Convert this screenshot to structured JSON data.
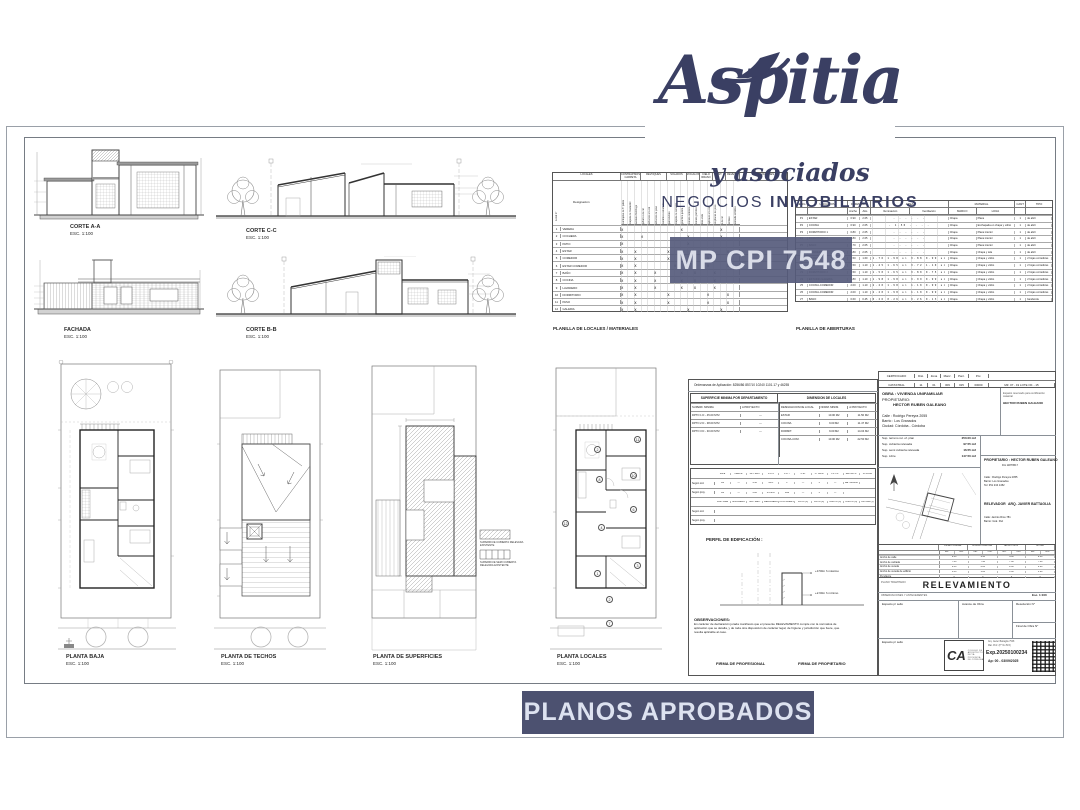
{
  "brand": {
    "name": "Aspitia",
    "tagline": "y asociados",
    "subtitle_prefix": "NEGOCIOS",
    "subtitle_bold": "INMOBILIARIOS",
    "badge": "MP CPI 7548",
    "accent": "#3a3f63"
  },
  "banner": {
    "label": "PLANOS APROBADOS"
  },
  "drawings": {
    "corte_aa": {
      "title": "CORTE A-A",
      "scale": "ESC. 1:100"
    },
    "fachada": {
      "title": "FACHADA",
      "scale": "ESC. 1:100"
    },
    "corte_cc": {
      "title": "CORTE C-C",
      "scale": "ESC. 1:100"
    },
    "corte_bb": {
      "title": "CORTE B-B",
      "scale": "ESC. 1:100"
    },
    "planta_baja": {
      "title": "PLANTA BAJA",
      "scale": "ESC. 1:100"
    },
    "planta_techos": {
      "title": "PLANTA DE TECHOS",
      "scale": "ESC. 1:100"
    },
    "planta_superficies": {
      "title": "PLANTA DE SUPERFICIES",
      "scale": "ESC. 1:100"
    },
    "planta_locales": {
      "title": "PLANTA LOCALES",
      "scale": "ESC. 1:100"
    }
  },
  "locales_table": {
    "title": "PLANILLA DE LOCALES / MATERIALES",
    "corner": "Local n°",
    "designacion": "Designación",
    "groups": [
      {
        "label": "LOCALES",
        "w": 68
      },
      {
        "label": "CONTRAPISOS CARPETA",
        "w": 20
      },
      {
        "label": "REVOQUES",
        "w": 26
      },
      {
        "label": "SOLADOS",
        "w": 20
      },
      {
        "label": "ZOCALOS",
        "w": 13
      },
      {
        "label": "CIELO RRASO",
        "w": 13
      },
      {
        "label": "PINT.",
        "w": 13
      },
      {
        "label": "REVEST.",
        "w": 14
      },
      {
        "label": "OBSERVACIONES",
        "w": 47
      }
    ],
    "materials": [
      "contrapiso de h° pobre",
      "carpeta de nivelación",
      "azotado hidrófugo",
      "jaharro a la cal",
      "enlucido a la cal",
      "enlucido de yeso",
      "cerámico esmaltado",
      "porcelanato",
      "carpeta de cemento",
      "granítico pulido",
      "zócalo cerámico",
      "zócalo granítico",
      "losa vista",
      "aplicado a la cal",
      "de placas de yeso",
      "a la cal",
      "al látex",
      "esmalte sintético"
    ],
    "rows": [
      {
        "n": "1",
        "name": "VEREDA",
        "marks": "x        x     x  "
      },
      {
        "n": "2",
        "name": "COCHERA",
        "marks": "x  x      x    x  "
      },
      {
        "n": "3",
        "name": "PATIO",
        "marks": "x         x       "
      },
      {
        "n": "4",
        "name": "ESTAR",
        "marks": "x x    x     x  x "
      },
      {
        "n": "5",
        "name": "COMEDOR",
        "marks": "x x    x     x  x "
      },
      {
        "n": "6",
        "name": "ESTAR COMEDOR",
        "marks": "x x     x    x  x "
      },
      {
        "n": "7",
        "name": "BAÑO",
        "marks": "x x  x   x x  x   "
      },
      {
        "n": "8",
        "name": "COCINA",
        "marks": "x x  x   x x  x   "
      },
      {
        "n": "9",
        "name": "LAVADERO",
        "marks": "x x  x   x x  x   "
      },
      {
        "n": "10",
        "name": "DORMITORIO",
        "marks": "x x    x     x  x "
      },
      {
        "n": "11",
        "name": "PASO",
        "marks": "x x    x     x  x "
      },
      {
        "n": "12",
        "name": "GALERIA",
        "marks": "x x       x    x  "
      }
    ]
  },
  "aberturas_table": {
    "title": "PLANILLA DE ABERTURAS",
    "h": {
      "desig": "DESIG.",
      "ubicacion": "UBICACION",
      "dim": "DIMENSION",
      "ancho": "Ancho",
      "alto": "Alto",
      "area": "AREA",
      "ilum": "Iluminación",
      "vent": "Ventilación",
      "material": "MATERIAL",
      "marco": "MARCO",
      "hoja": "HOJA",
      "cant": "CANT",
      "tipo": "TIPO"
    },
    "rows": [
      {
        "d": "P1",
        "u": "ESTAR",
        "an": "0.90",
        "al": "2.05",
        "ar": "-   -   -   -   -   -",
        "ma": "Chapa",
        "ho": "Placa",
        "c": "1",
        "t": "de abrir"
      },
      {
        "d": "P2",
        "u": "COCINA",
        "an": "0.90",
        "al": "2.05",
        "ar": "-   1.50  -   -   -   -",
        "ma": "Chapa",
        "ho": "Enchapada en chapa y vidrio",
        "c": "1",
        "t": "de abrir"
      },
      {
        "d": "P3",
        "u": "DORMITORIO 1",
        "an": "0.80",
        "al": "2.05",
        "ar": "-   -   -   -   -   -",
        "ma": "Chapa",
        "ho": "Placa interior",
        "c": "1",
        "t": "de abrir"
      },
      {
        "d": "P4",
        "u": "DORMITORIO 2",
        "an": "0.80",
        "al": "2.05",
        "ar": "-   -   -   -   -   -",
        "ma": "Chapa",
        "ho": "Placa interior",
        "c": "1",
        "t": "de abrir"
      },
      {
        "d": "P5",
        "u": "BAÑO",
        "an": "0.70",
        "al": "2.05",
        "ar": "-   -   -   -   -   -",
        "ma": "Chapa",
        "ho": "Placa interior",
        "c": "1",
        "t": "de abrir"
      },
      {
        "d": "P6",
        "u": "LAVADERO",
        "an": "0.80",
        "al": "2.05",
        "ar": "-   -   -   -   -   -",
        "ma": "Chapa",
        "ho": "Chapa y tela",
        "c": "1",
        "t": "de abrir"
      },
      {
        "d": "V1",
        "u": "ESTAR",
        "an": "1.50",
        "al": "1.60",
        "ar": "1.76 1.98 si 0.88 0.99 si",
        "ma": "Chapa",
        "ho": "Chapa y vidrio",
        "c": "1",
        "t": "2 hojas corredizas"
      },
      {
        "d": "V2",
        "u": "DORMITORIO 1",
        "an": "1.50",
        "al": "1.10",
        "ar": "1.45 1.65 si 0.72 1.10 si",
        "ma": "Chapa",
        "ho": "Chapa y vidrio",
        "c": "1",
        "t": "2 hojas corredizas"
      },
      {
        "d": "V3",
        "u": "DORMITORIO 2",
        "an": "1.50",
        "al": "1.10",
        "ar": "1.50 1.65 si 0.80 0.75 si",
        "ma": "Chapa",
        "ho": "Chapa y vidrio",
        "c": "1",
        "t": "2 hojas corredizas"
      },
      {
        "d": "V4",
        "u": "ESTUDIO-GALERIA",
        "an": "1.80",
        "al": "1.10",
        "ar": "1.98 1.98 si 0.99 0.99 si",
        "ma": "Chapa",
        "ho": "Chapa y vidrio",
        "c": "1",
        "t": "2 hojas corredizas"
      },
      {
        "d": "V5",
        "u": "COCINA-COMEDOR",
        "an": "2.00",
        "al": "1.10",
        "ar": "2.20 1.98 si 1.10 0.99 si",
        "ma": "Chapa",
        "ho": "Chapa y vidrio",
        "c": "1",
        "t": "2 hojas corredizas"
      },
      {
        "d": "V6",
        "u": "COCINA-COMEDOR",
        "an": "2.00",
        "al": "1.10",
        "ar": "2.20 1.98 si 1.10 0.99 si",
        "ma": "Chapa",
        "ho": "Chapa y vidrio",
        "c": "1",
        "t": "2 hojas corredizas"
      },
      {
        "d": "V7",
        "u": "BAÑO",
        "an": "0.60",
        "al": "0.45",
        "ar": "0.26 0.26 si 0.26 0.13 si",
        "ma": "Chapa",
        "ho": "Chapa y vidrio",
        "c": "1",
        "t": "banderola"
      }
    ]
  },
  "titleblock": {
    "ordenanzas": "Ordenanzas de Aplicación:    8256/86    857/10    10240    1101.17    y    46255",
    "sup_min": {
      "header": "SUPERFICIE MINIMA POR DEPARTAMENTO",
      "col1": "SUPERF. MINIMA",
      "col2": "A PROYECTO",
      "rows": [
        {
          "a": "DPTO 1 D - 45.00 MT2",
          "b": "—"
        },
        {
          "a": "DPTO 2 D - 38.00 MT2",
          "b": "—"
        },
        {
          "a": "DPTO 3 D - 30.00 MT2",
          "b": "—"
        }
      ]
    },
    "dim_locales": {
      "header": "DIMENSION DE LOCALES",
      "col1": "DESIGNACION DE LOCAL",
      "col2": "NORM. MINIM.",
      "col3": "A PROYECTO",
      "rows": [
        {
          "local": "ESTAR",
          "norm": "10.00 M2",
          "proy": "11.50 M2"
        },
        {
          "local": "COCINA",
          "norm": "9.00 M2",
          "proy": "11.47 M2"
        },
        {
          "local": "DORMIT.",
          "norm": "9.00 M2",
          "proy": "14.04 M2"
        },
        {
          "local": "COCINA-COM.",
          "norm": "10.00 M2",
          "proy": "22.50 M2"
        }
      ]
    },
    "indicadores": {
      "rows": [
        {
          "label": "",
          "cells": [
            "Zona",
            "PERFIL",
            "ALT. MAX",
            "F.O.S",
            "F.O.T",
            "C.M.",
            "N° UNID",
            "PL. PL.",
            "RETIRO F.",
            "S/ ZONA"
          ]
        },
        {
          "label": "Según ord.",
          "cells": [
            "R2",
            "—",
            "4.50",
            "60%",
            "1",
            "—",
            "1",
            "—",
            "Bal. 6256/86",
            ""
          ]
        },
        {
          "label": "Según proy.",
          "cells": [
            "R2",
            "—",
            "3.00",
            "45.52%",
            "1+E",
            "—",
            "1",
            "—",
            "",
            ""
          ]
        },
        {
          "label": "",
          "cells": [
            "PAR. AIRE",
            "ESCALERA",
            "SUP. MEC.",
            "MEDIANERA",
            "CON. ABIERTA",
            "PATIO (1)",
            "PATIO (2)",
            "ANCHO (3)",
            "ANCHO (4)",
            "ALTURA (5)"
          ]
        },
        {
          "label": "Según ord.",
          "cells": [
            "",
            "",
            "",
            "",
            "",
            "",
            "",
            "",
            "",
            ""
          ]
        },
        {
          "label": "Según proy.",
          "cells": [
            "",
            "",
            "",
            "",
            "",
            "",
            "",
            "",
            "",
            ""
          ]
        }
      ]
    },
    "perfil": {
      "label": "PERFIL DE EDIFICACIÓN :",
      "ann1": "+3.50m  h máximo",
      "ann2": "+2.60m  h mínimo"
    },
    "observaciones": {
      "title": "OBSERVACIONES:",
      "line1": "En carácter de declaración jurada manifiesto que el presente RELEVAMIENTO cumple con la normativa de",
      "line2": "aplicación que se detalla, y de toda otra disposición de carácter legal, de higiene y jurisdicción que fuere, que",
      "line3": "resulta aplicable al caso."
    },
    "firmas": {
      "profesional": "FIRMA  DE PROFESIONAL",
      "propietario": "FIRMA DE PROPIETARIO"
    }
  },
  "certificado": {
    "rows": [
      {
        "c": [
          "CERTIFICADO",
          "Dist.",
          "Zona",
          "Manz.",
          "Parc.",
          "P.H.",
          ""
        ]
      },
      {
        "c": [
          "CATASTRAL",
          "11",
          "01",
          "009",
          "015",
          "00000",
          "MZ. 07 - 19    LOTE OF. - 15"
        ]
      }
    ]
  },
  "obra": {
    "line1": "OBRA : VIVIENDA UNIFAMILIAR",
    "prop_label": "PROPIETARIO:",
    "prop_name": "HECTOR RUBEN GALEANO",
    "calle": "Calle  :  Rodrigo Pereyra 2055",
    "barrio": "Barrio :  Los Granados",
    "ciudad": "Ciudad:  Córdoba - Córdoba",
    "reserved": "Espacio reservado para certificación catastral",
    "reserved_name": "HECTOR RUBEN GALEANO"
  },
  "superficies": [
    {
      "label": "Sup. terreno rel. of. plan",
      "value": "250.00 m2"
    },
    {
      "label": "Sup. cubierta relevada",
      "value": "97.55 m2"
    },
    {
      "label": "Sup. semi cubierta relevada",
      "value": "16.55 m2"
    },
    {
      "label": "Sup. Libre",
      "value": "147.50 m2"
    }
  ],
  "parties": {
    "prop_title": "PROPIETARIO :  HECTOR RUBEN GALEANO",
    "prop_dni": "Dni 11879517",
    "prop_calle": "Calle : Rodrigo Pereyra 2055",
    "prop_barrio": "Barrio: Los Granados",
    "prop_tel": "Tel: 351 234 1452",
    "rel_label": "RELEVADOR",
    "rel_name": "ARQ. JAVIER BATTAGLIA",
    "rel_calle": "Calle: Jacinto Ríos 781",
    "rel_barrio": "Barrio: Gral. Paz"
  },
  "anchos": {
    "sub": [
      "REL.",
      "ORD."
    ],
    "groups": [
      {
        "name": "ESTADO PREDIAL"
      },
      {
        "name": "RODRIGO PEREYRA"
      },
      {
        "name": "JACINTO RIOS"
      },
      {
        "name": "RIO PAZ"
      }
    ],
    "rows": [
      {
        "label": "Ancho de calle",
        "vals": [
          "9.40",
          "9.40",
          "9.40",
          "9.40"
        ]
      },
      {
        "label": "Ancho de calzada",
        "vals": [
          "7.40",
          "7.40",
          "7.40",
          "7.40"
        ]
      },
      {
        "label": "Ancho de vereda",
        "vals": [
          "2.00",
          "2.00",
          "2.00",
          "2.00"
        ]
      },
      {
        "label": "Ancho de vereda de edificio",
        "vals": [
          "1.00",
          "1.00",
          "1.00",
          "1.00"
        ]
      },
      {
        "label": "Pendiente",
        "vals": [
          "0",
          "0",
          "0",
          "0"
        ]
      }
    ]
  },
  "relevamiento": {
    "plano_label": "PLANO TRAMITADO:",
    "title": "RELEVAMIENTO",
    "antecedentes": "OBSERVACIONES Y ANTECEDENTES",
    "esc": "Esc. 1:100"
  },
  "cells": {
    "sello1": "Espacio p/ sello",
    "avance": "Avance de Obra",
    "resolucion": "Resolución N°",
    "final": "Final de Obra N°",
    "sello2": "Espacio p/ sello"
  },
  "stamp": {
    "ca": "CA",
    "ca_text1": "COLEGIO DE",
    "ca_text2": "ARQUITECTOS",
    "ca_text3": "DE LA PROVINCIA",
    "ca_text4": "DE CÓRDOBA",
    "line1": "Arq. Javier Battaglia 7548",
    "line2": "Mat. Prof. (P° No 515)",
    "exp": "Exp.20250100234",
    "ap": "Ap: 00 - 03/09/2025"
  },
  "superficie_legend": [
    {
      "l1": "SUPERFICIE CUBIERTA RELEVADA",
      "l2": "EXISTENTE"
    },
    {
      "l1": "SUPERFICIE SEMI CUBIERTA",
      "l2": "RELEVADA EXISTENTE"
    }
  ],
  "planta_locales_numbers": [
    {
      "n": "2",
      "x": 44,
      "y": 86
    },
    {
      "n": "11",
      "x": 84,
      "y": 76
    },
    {
      "n": "10",
      "x": 80,
      "y": 112
    },
    {
      "n": "8",
      "x": 46,
      "y": 116
    },
    {
      "n": "6",
      "x": 80,
      "y": 146
    },
    {
      "n": "12",
      "x": 12,
      "y": 160
    },
    {
      "n": "4",
      "x": 48,
      "y": 164
    },
    {
      "n": "3",
      "x": 84,
      "y": 202
    },
    {
      "n": "1",
      "x": 44,
      "y": 210
    },
    {
      "n": "2",
      "x": 56,
      "y": 236
    },
    {
      "n": "7",
      "x": 56,
      "y": 260
    }
  ]
}
